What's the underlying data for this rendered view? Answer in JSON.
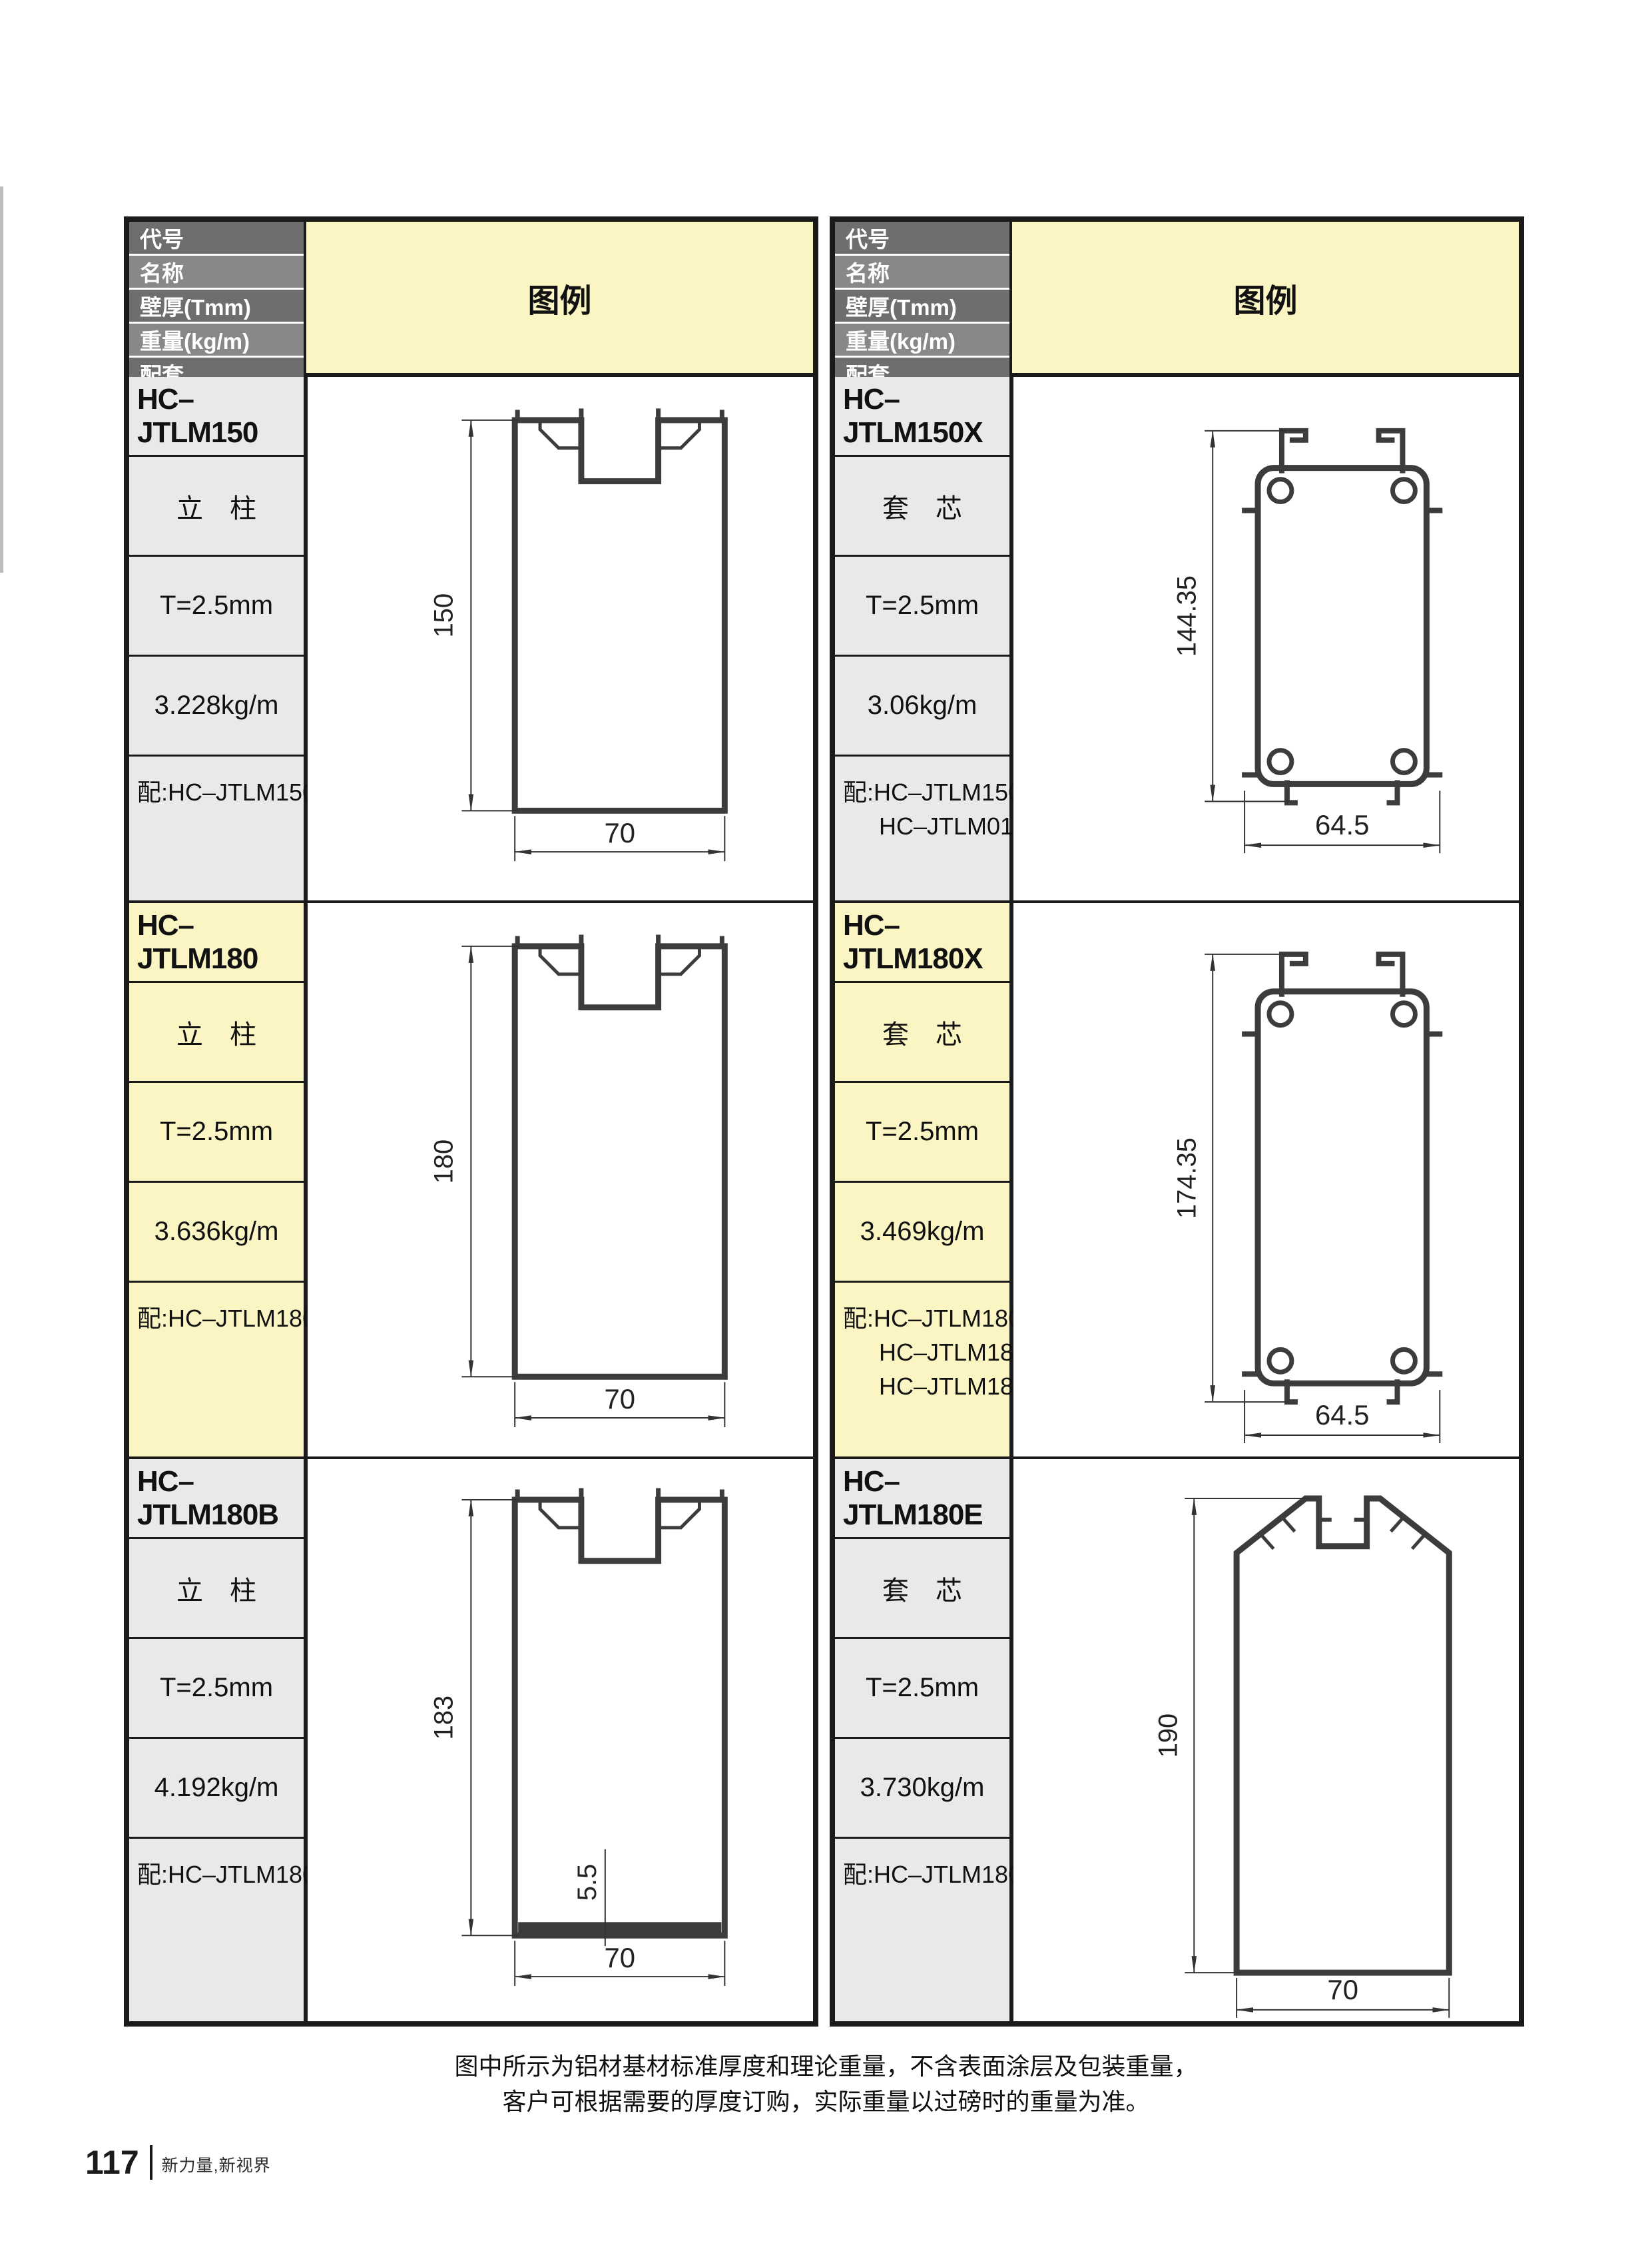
{
  "page": {
    "notes": {
      "line1": "图中所示为铝材基材标准厚度和理论重量，不含表面涂层及包装重量，",
      "line2": "客户可根据需要的厚度订购，实际重量以过磅时的重量为准。"
    },
    "footer": {
      "page_number": "117",
      "slogan": "新力量,新视界"
    }
  },
  "table_header": {
    "code": "代号",
    "name": "名称",
    "thickness": "壁厚(Tmm)",
    "weight": "重量(kg/m)",
    "accessory": "配套",
    "legend": "图例"
  },
  "colors": {
    "legend_yellow": "#faf5c3",
    "header_gray_dark": "#6e6e6e",
    "header_gray_light": "#888888",
    "cell_gray": "#e9e9e9",
    "table_border": "#1a1a1a",
    "profile_stroke": "#3c3c3c"
  },
  "left_table": {
    "rows": [
      {
        "code": "HC–JTLM150",
        "name": "立　柱",
        "thickness": "T=2.5mm",
        "weight": "3.228kg/m",
        "match1": "配:HC–JTLM150X",
        "match2": "",
        "match3": "",
        "dim_height": "150",
        "dim_width": "70",
        "dim_extra": ""
      },
      {
        "code": "HC–JTLM180",
        "name": "立　柱",
        "thickness": "T=2.5mm",
        "weight": "3.636kg/m",
        "match1": "配:HC–JTLM180X",
        "match2": "",
        "match3": "",
        "dim_height": "180",
        "dim_width": "70",
        "dim_extra": ""
      },
      {
        "code": "HC–JTLM180B",
        "name": "立　柱",
        "thickness": "T=2.5mm",
        "weight": "4.192kg/m",
        "match1": "配:HC–JTLM180X",
        "match2": "",
        "match3": "",
        "dim_height": "183",
        "dim_width": "70",
        "dim_extra": "5.5"
      }
    ]
  },
  "right_table": {
    "rows": [
      {
        "code": "HC–JTLM150X",
        "name": "套　芯",
        "thickness": "T=2.5mm",
        "weight": "3.06kg/m",
        "match1": "配:HC–JTLM150",
        "match2": "HC–JTLM017A",
        "match3": "",
        "dim_height": "144.35",
        "dim_width": "64.5",
        "dim_extra": ""
      },
      {
        "code": "HC–JTLM180X",
        "name": "套　芯",
        "thickness": "T=2.5mm",
        "weight": "3.469kg/m",
        "match1": "配:HC–JTLM180",
        "match2": "HC–JTLM180B",
        "match3": "HC–JTLM180E",
        "dim_height": "174.35",
        "dim_width": "64.5",
        "dim_extra": ""
      },
      {
        "code": "HC–JTLM180E",
        "name": "套　芯",
        "thickness": "T=2.5mm",
        "weight": "3.730kg/m",
        "match1": "配:HC–JTLM180X",
        "match2": "",
        "match3": "",
        "dim_height": "190",
        "dim_width": "70",
        "dim_extra": ""
      }
    ]
  }
}
